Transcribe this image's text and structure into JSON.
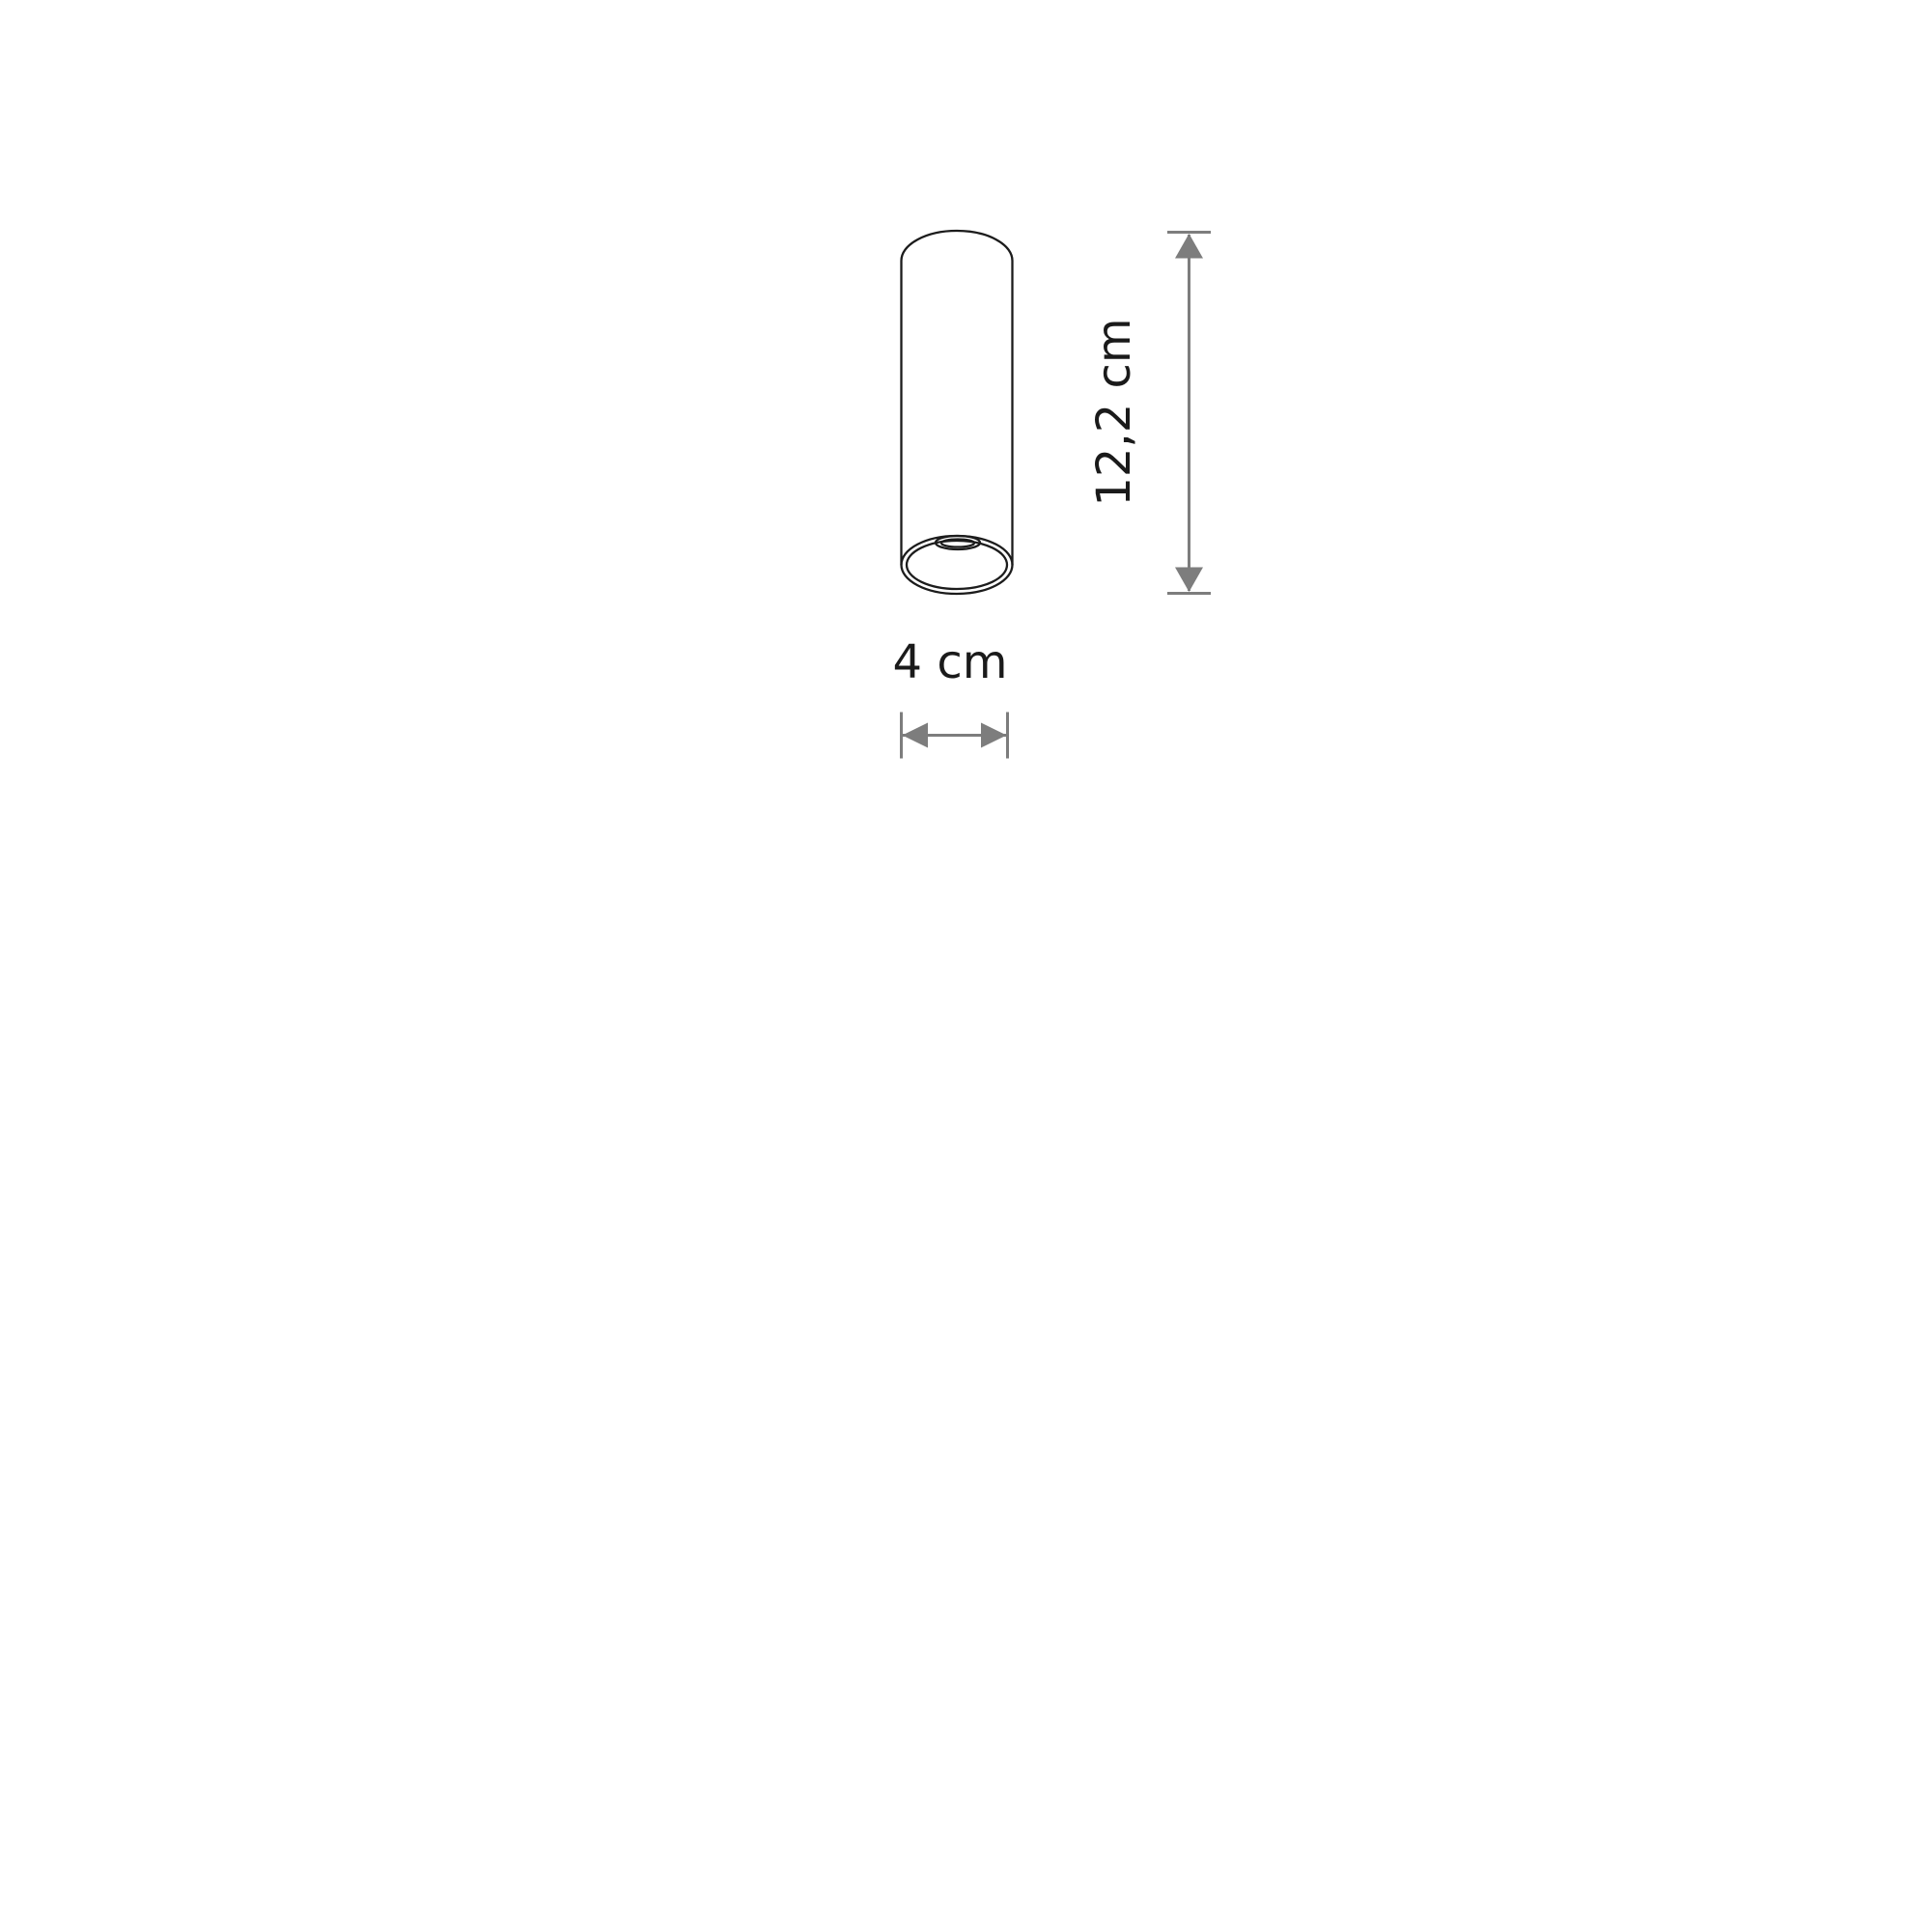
{
  "colors": {
    "ink": "#1c1c1c",
    "dim": "#7d7d7d",
    "text": "#1a1a1a",
    "background": "#ffffff"
  },
  "dimensions": {
    "height": {
      "label": "12,2 cm"
    },
    "width": {
      "label": "4 cm"
    }
  }
}
